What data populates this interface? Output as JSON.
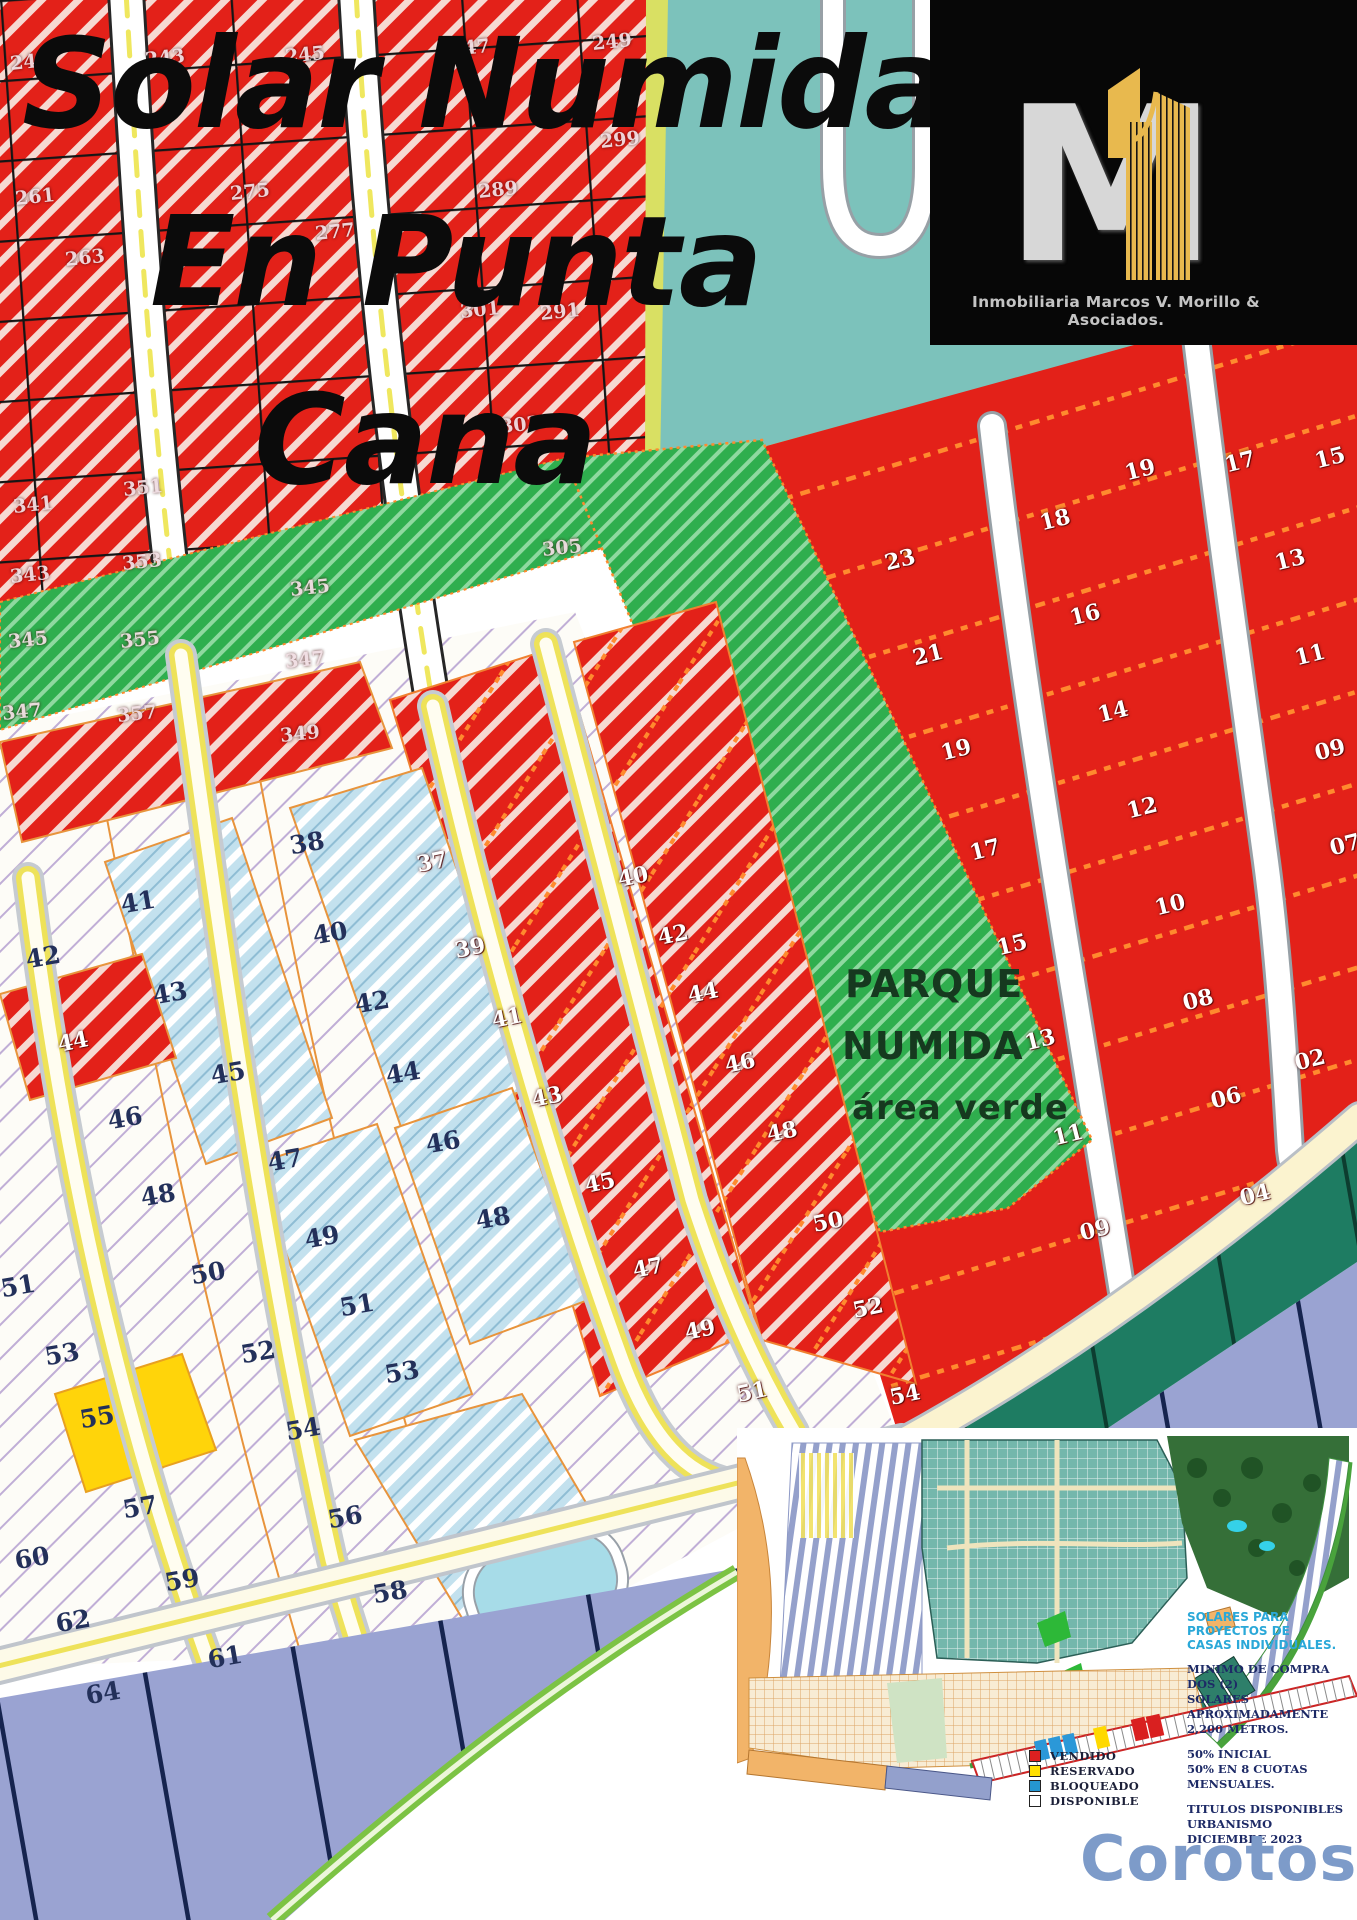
{
  "title": {
    "line1": "Solar Numida",
    "line2": "En Punta",
    "line3": "Cana"
  },
  "brand": {
    "monogram": "M",
    "caption": "Inmobiliaria Marcos V. Morillo & Asociados."
  },
  "park_label": {
    "line1": "PARQUE",
    "line2": "NUMIDA",
    "line3": "área verde"
  },
  "watermark": {
    "text": "Corotos",
    "color": "#7d9bc9"
  },
  "inset": {
    "heading": [
      "SOLARES PARA PROYECTOS DE",
      "CASAS INDIVIDUALES."
    ],
    "body": [
      "MINIMO DE COMPRA DOS (2)",
      "SOLARES APROXIMADAMENTE",
      "2,200 METROS.",
      "",
      "50% INICIAL",
      "50% EN 8 CUOTAS MENSUALES.",
      "",
      "TITULOS DISPONIBLES",
      "URBANISMO DICIEMBRE 2023"
    ],
    "legend": [
      {
        "label": "VENDIDO",
        "color": "#dd2020"
      },
      {
        "label": "RESERVADO",
        "color": "#ffdf00"
      },
      {
        "label": "BLOQUEADO",
        "color": "#2596d1"
      },
      {
        "label": "DISPONIBLE",
        "color": "#ffffff"
      }
    ]
  },
  "status_colors": {
    "vendido": "#e3211a",
    "reservado": "#ffd40a",
    "bloqueado": "#bcdcec",
    "disponible": "#ffffff",
    "parque_verde": "#2fae4e"
  },
  "lot_labels": {
    "top_left_sold": {
      "c": "tl",
      "r": -6,
      "items": [
        [
          33,
          505,
          "341"
        ],
        [
          30,
          575,
          "343"
        ],
        [
          28,
          640,
          "345"
        ],
        [
          22,
          712,
          "347"
        ],
        [
          143,
          488,
          "351"
        ],
        [
          142,
          562,
          "353"
        ],
        [
          140,
          640,
          "355"
        ],
        [
          137,
          714,
          "357"
        ],
        [
          310,
          588,
          "345"
        ],
        [
          305,
          660,
          "347"
        ],
        [
          300,
          734,
          "349"
        ],
        [
          35,
          197,
          "261"
        ],
        [
          85,
          258,
          "263"
        ],
        [
          250,
          192,
          "275"
        ],
        [
          335,
          232,
          "277"
        ],
        [
          498,
          190,
          "289"
        ],
        [
          560,
          312,
          "291"
        ],
        [
          30,
          62,
          "241"
        ],
        [
          165,
          58,
          "243"
        ],
        [
          305,
          55,
          "245"
        ],
        [
          470,
          48,
          "247"
        ],
        [
          612,
          42,
          "249"
        ],
        [
          480,
          310,
          "301"
        ],
        [
          520,
          425,
          "303"
        ],
        [
          562,
          548,
          "305"
        ],
        [
          620,
          140,
          "299"
        ]
      ]
    },
    "middle_sold": {
      "c": "lt",
      "r": -12,
      "items": [
        [
          432,
          862,
          "37"
        ],
        [
          470,
          948,
          "39"
        ],
        [
          507,
          1018,
          "41"
        ],
        [
          547,
          1097,
          "43"
        ],
        [
          600,
          1183,
          "45"
        ],
        [
          648,
          1268,
          "47"
        ],
        [
          700,
          1330,
          "49"
        ],
        [
          752,
          1392,
          "51"
        ],
        [
          633,
          877,
          "40"
        ],
        [
          673,
          935,
          "42"
        ],
        [
          703,
          993,
          "44"
        ],
        [
          740,
          1063,
          "46"
        ],
        [
          782,
          1132,
          "48"
        ],
        [
          828,
          1222,
          "50"
        ],
        [
          868,
          1308,
          "52"
        ],
        [
          905,
          1395,
          "54"
        ],
        [
          73,
          1042,
          "44"
        ]
      ]
    },
    "right_sold": {
      "c": "lt",
      "r": -14,
      "items": [
        [
          1140,
          470,
          "19"
        ],
        [
          1240,
          462,
          "17"
        ],
        [
          1330,
          458,
          "15"
        ],
        [
          900,
          560,
          "23"
        ],
        [
          928,
          655,
          "21"
        ],
        [
          956,
          750,
          "19"
        ],
        [
          985,
          850,
          "17"
        ],
        [
          1012,
          945,
          "15"
        ],
        [
          1040,
          1040,
          "13"
        ],
        [
          1068,
          1135,
          "11"
        ],
        [
          1095,
          1230,
          "09"
        ],
        [
          1055,
          520,
          "18"
        ],
        [
          1085,
          615,
          "16"
        ],
        [
          1113,
          712,
          "14"
        ],
        [
          1142,
          808,
          "12"
        ],
        [
          1170,
          905,
          "10"
        ],
        [
          1198,
          1000,
          "08"
        ],
        [
          1226,
          1098,
          "06"
        ],
        [
          1255,
          1195,
          "04"
        ],
        [
          1290,
          560,
          "13"
        ],
        [
          1310,
          655,
          "11"
        ],
        [
          1330,
          750,
          "09"
        ],
        [
          1345,
          845,
          "07"
        ],
        [
          1310,
          1060,
          "02"
        ]
      ]
    },
    "left_blocks": {
      "c": "dk",
      "r": -10,
      "items": [
        [
          43,
          957,
          "42"
        ],
        [
          125,
          1118,
          "46"
        ],
        [
          18,
          1286,
          "51"
        ],
        [
          62,
          1354,
          "53"
        ],
        [
          97,
          1417,
          "55"
        ],
        [
          32,
          1558,
          "60"
        ],
        [
          73,
          1621,
          "62"
        ],
        [
          103,
          1693,
          "64"
        ],
        [
          138,
          902,
          "41"
        ],
        [
          170,
          993,
          "43"
        ],
        [
          228,
          1073,
          "45"
        ],
        [
          158,
          1195,
          "48"
        ],
        [
          208,
          1273,
          "50"
        ],
        [
          258,
          1352,
          "52"
        ],
        [
          303,
          1429,
          "54"
        ],
        [
          140,
          1507,
          "57"
        ],
        [
          182,
          1580,
          "59"
        ],
        [
          225,
          1657,
          "61"
        ],
        [
          307,
          843,
          "38"
        ],
        [
          330,
          933,
          "40"
        ],
        [
          372,
          1002,
          "42"
        ],
        [
          403,
          1073,
          "44"
        ],
        [
          285,
          1160,
          "47"
        ],
        [
          322,
          1237,
          "49"
        ],
        [
          357,
          1305,
          "51"
        ],
        [
          402,
          1372,
          "53"
        ],
        [
          345,
          1517,
          "56"
        ],
        [
          390,
          1592,
          "58"
        ],
        [
          443,
          1142,
          "46"
        ],
        [
          493,
          1218,
          "48"
        ]
      ]
    }
  }
}
